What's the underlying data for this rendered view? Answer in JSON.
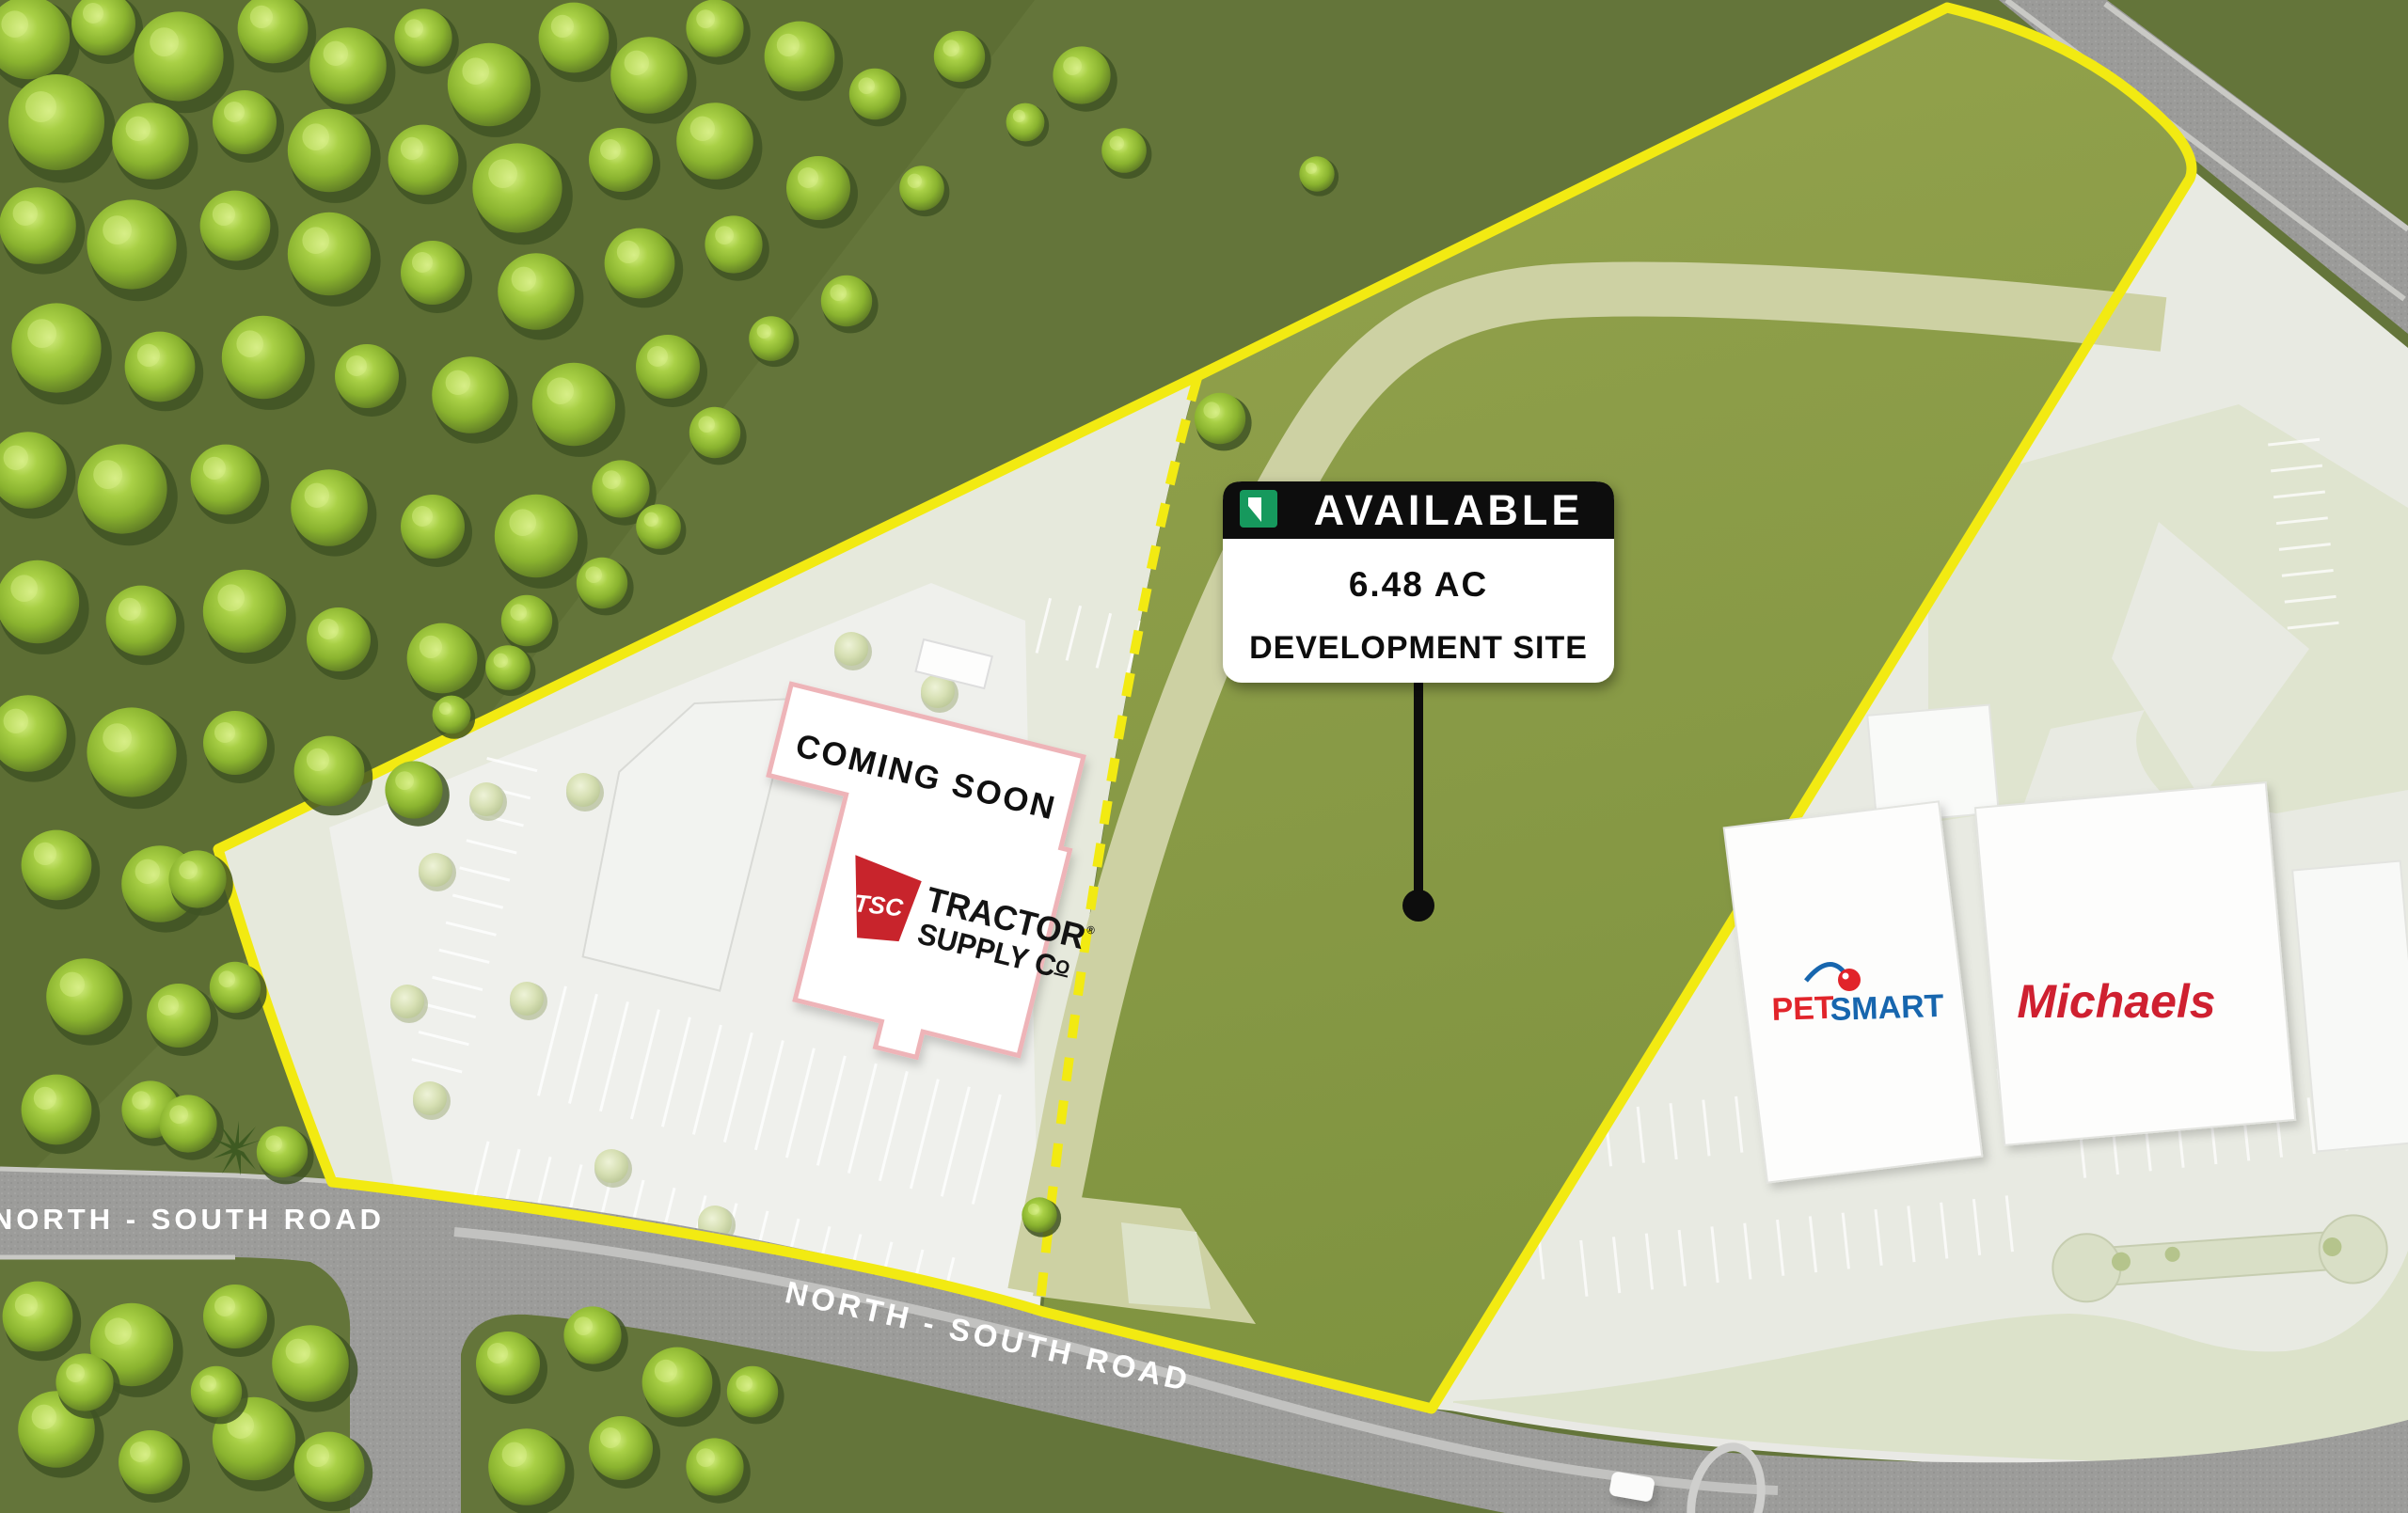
{
  "sign": {
    "badge": "AVAILABLE",
    "area": "6.48 AC",
    "descriptor": "DEVELOPMENT SITE"
  },
  "coming_soon": {
    "label": "COMING SOON"
  },
  "tractor_supply": {
    "abbr": "TSC",
    "name_line1": "TRACTOR",
    "name_line1_reg": "®",
    "name_line2": "SUPPLY C",
    "name_line2_sup": "O"
  },
  "tenants": {
    "petsmart_part1": "PET",
    "petsmart_part2": "SMART",
    "michaels": "Michaels"
  },
  "roads": {
    "west_label": "NORTH - SOUTH ROAD",
    "south_label": "NORTH - SOUTH ROAD"
  },
  "colors": {
    "boundary_yellow": "#f2ea12",
    "site_olive": "#8a9b45",
    "sign_green": "#15995d",
    "sign_black": "#0d0d0d",
    "tsc_red": "#c8242c",
    "petsmart_red": "#e1242a",
    "petsmart_blue": "#1766ae",
    "michaels_red": "#cf2030"
  }
}
